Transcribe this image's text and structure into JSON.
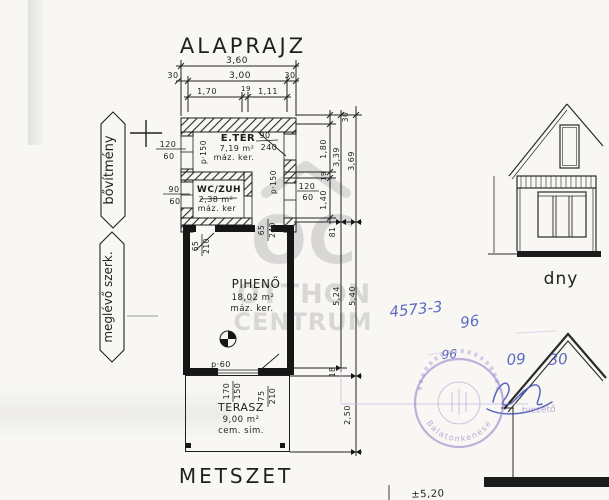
{
  "page": {
    "title_plan": "ALAPRAJZ",
    "title_section": "METSZET",
    "elevation_label": "dny"
  },
  "side_labels": {
    "extension": "bővítmény",
    "existing": "meglévő szerk."
  },
  "rooms": {
    "eter": {
      "name": "E.TÉR",
      "area": "7,19 m²",
      "finish": "máz. ker."
    },
    "wc": {
      "name": "WC/ZUH",
      "area": "2,38 m²",
      "finish": "máz. ker"
    },
    "piheno": {
      "name": "PIHENŐ",
      "area": "18,02 m²",
      "finish": "máz. ker."
    },
    "terasz": {
      "name": "TERASZ",
      "area": "9,00 m²",
      "finish": "cem. sim."
    }
  },
  "dims_top": {
    "total": "3,60",
    "wall_l": "30",
    "inner": "3,00",
    "wall_r": "30",
    "seg1": "1,70",
    "seg2": "19",
    "seg3": "1,11"
  },
  "dims_left": {
    "win1": {
      "w": "120",
      "h": "60"
    },
    "win2": {
      "w": "90",
      "h": "60"
    }
  },
  "dims_right_chain": {
    "top": "30",
    "s1": "1,80",
    "s2": "19",
    "s3": "1,40",
    "s4": "81",
    "sub": "3,39",
    "sub_outer": "3,69",
    "total_inner": "5,24",
    "total_outer": "5,40",
    "step": "18",
    "terasz": "2,50"
  },
  "openings": {
    "door_main": {
      "w": "90",
      "h": "240"
    },
    "win_right": {
      "w": "120",
      "h": "60"
    },
    "door_piheno": {
      "w": "65",
      "h": "210"
    },
    "opening_right": {
      "w": "65",
      "h": "240"
    },
    "parapet_left": "p·150",
    "parapet_mid": "p·150",
    "parapet_terasz": "p·60"
  },
  "dims_terasz": {
    "a1": "170",
    "a2": "150",
    "b1": "75",
    "b2": "210"
  },
  "watermark": {
    "monogram": "OC",
    "line1": "OTTHON",
    "line2": "CENTRUM"
  },
  "handwriting": {
    "file_no": "4573-3",
    "num1": "96",
    "num2": "96",
    "month": "09",
    "day": "30",
    "level": "±5,20"
  },
  "stamp": {
    "arc_text": "Balatonkenese",
    "fragment": "tvezető"
  }
}
